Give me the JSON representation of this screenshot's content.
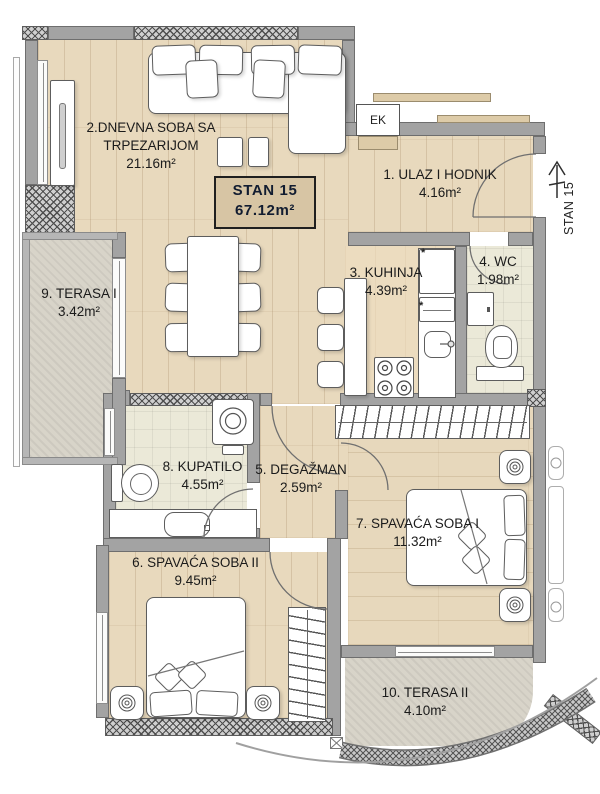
{
  "plan_title": {
    "unit_label": "STAN 15",
    "unit_area": "67.12m²"
  },
  "entry_marker": {
    "label": "STAN 15"
  },
  "shaft": {
    "label": "EK"
  },
  "icons": {
    "vent_star": "*"
  },
  "rooms": {
    "ulaz": {
      "name": "1. ULAZ I HODNIK",
      "area": "4.16m²"
    },
    "dnevna": {
      "line1": "2.DNEVNA SOBA SA",
      "line2": "TRPEZARIJOM",
      "area": "21.16m²"
    },
    "kuhinja": {
      "name": "3. KUHINJA",
      "area": "4.39m²"
    },
    "wc": {
      "name": "4. WC",
      "area": "1.98m²"
    },
    "degazman": {
      "name": "5. DEGAŽMAN",
      "area": "2.59m²"
    },
    "soba2": {
      "name": "6. SPAVAĆA SOBA II",
      "area": "9.45m²"
    },
    "soba1": {
      "name": "7. SPAVAĆA SOBA I",
      "area": "11.32m²"
    },
    "kupatilo": {
      "name": "8. KUPATILO",
      "area": "4.55m²"
    },
    "terasa1": {
      "name": "9. TERASA I",
      "area": "3.42m²"
    },
    "terasa2": {
      "name": "10. TERASA II",
      "area": "4.10m²"
    }
  },
  "colors": {
    "wall": "#a3a3a3",
    "wood_floor": "#e8d9bd",
    "tile_floor": "#ebe9d8",
    "terrace_floor": "#d8d4c9",
    "kitchen_floor": "#ecdcbf",
    "title_box_bg": "#d7c5a4"
  }
}
